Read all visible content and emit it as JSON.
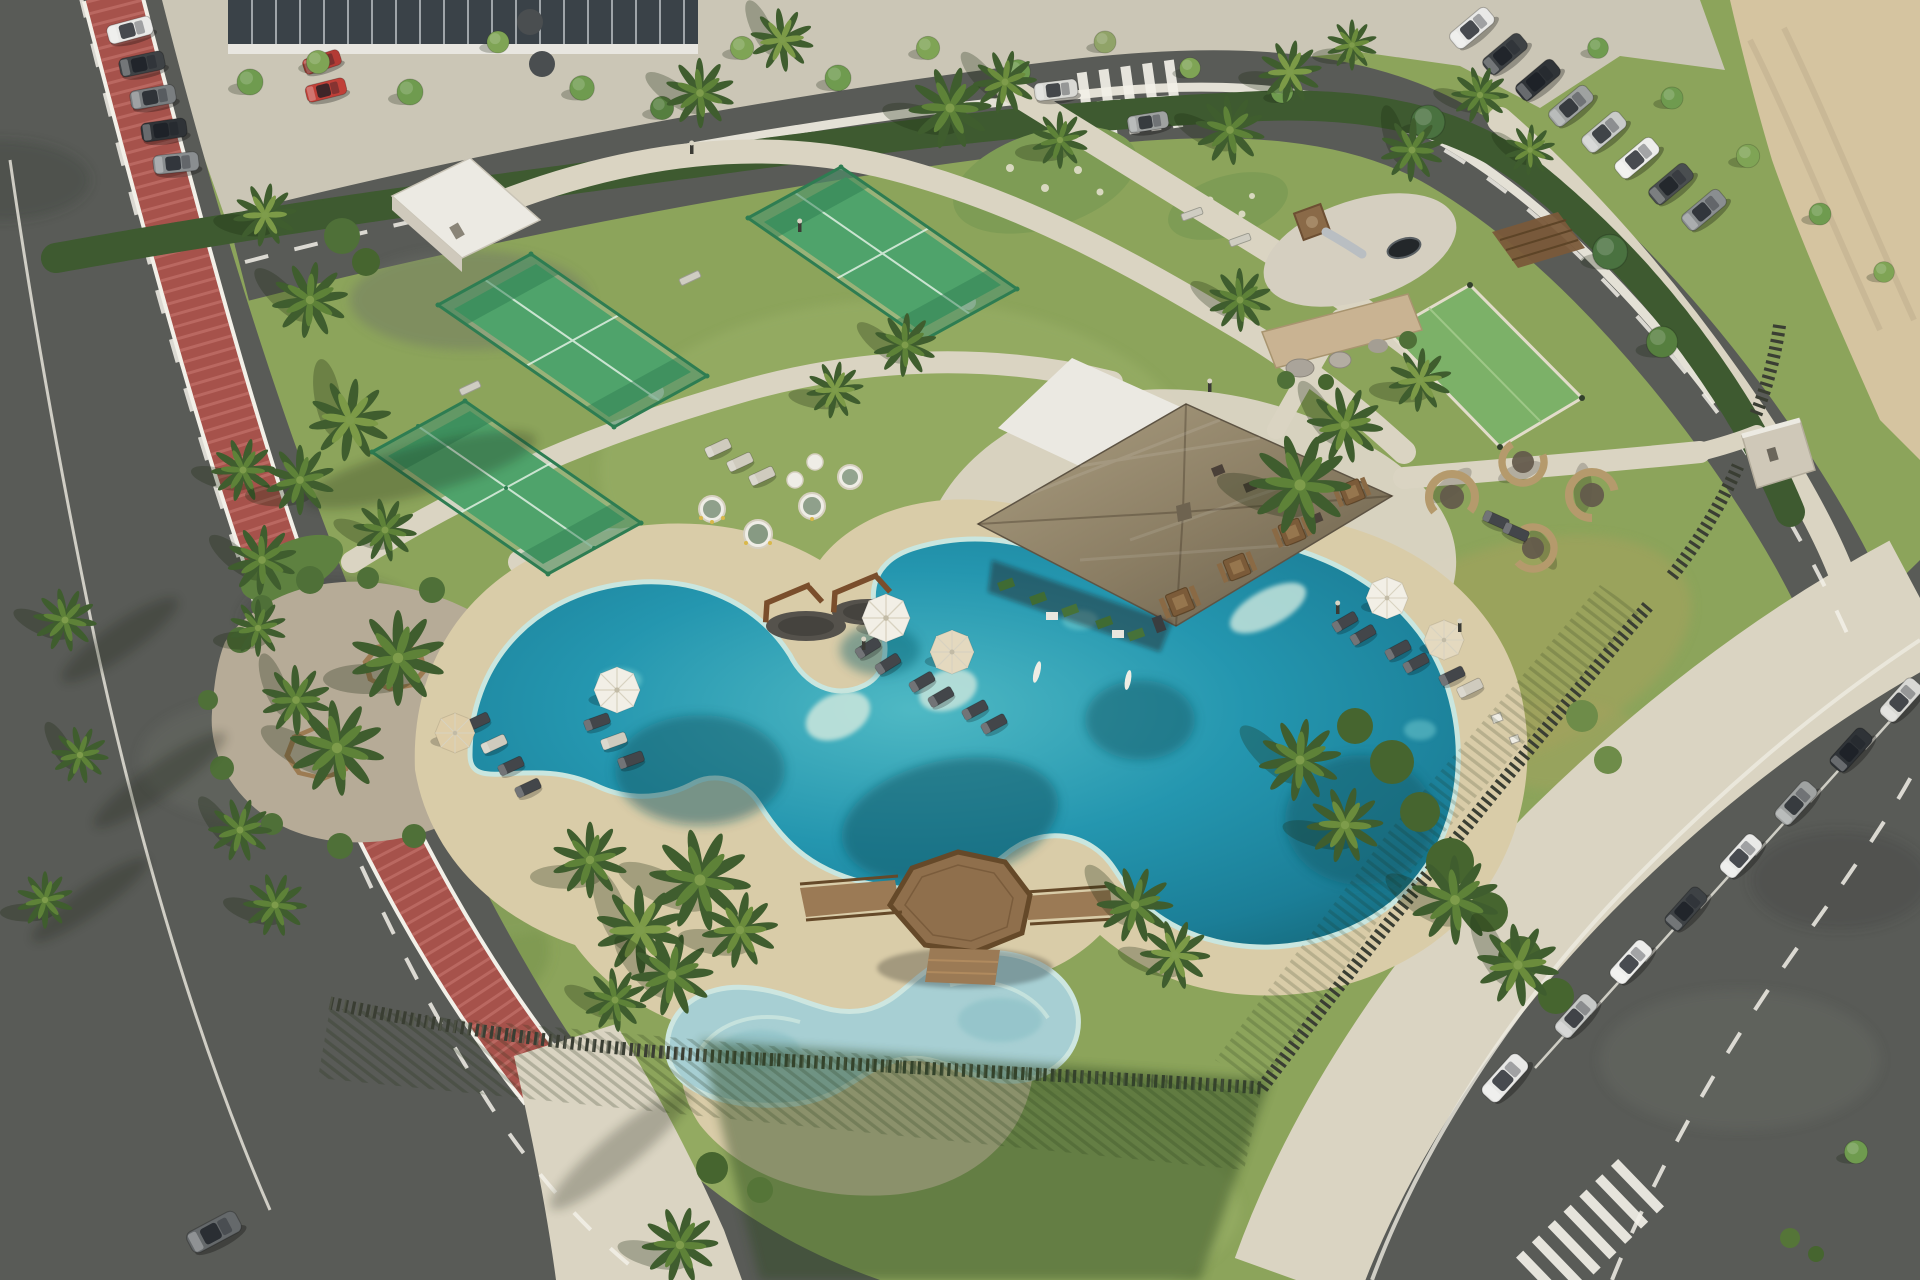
{
  "scene": {
    "title": "Resort amenity park, aerial view",
    "description": "Aerial 3D rendering of a coastal residential amenity park: three glass-walled padel courts, a thatched-roof pool pavilion, a free-form turquoise lagoon pool with sandy deck, a children's splash pool joined by an octagonal timber deck, playground, picnic grove with circular tree benches, lounge pods, lawns and palm trees, ringed by a road with a red bike lane on the west, a curved access road on the north, angled parking rows full of cars on the east, and a bare sand lot in the north-east corner."
  },
  "palette": {
    "grass": "#8CA45B",
    "grassLight": "#A7B874",
    "grassDark": "#6A8A44",
    "hedge": "#3E5A30",
    "sandLot": "#D5C4A0",
    "plaza": "#CBC6B6",
    "path": "#DAD4C2",
    "poolDeck": "#D9CCA8",
    "road": "#595B57",
    "bike": "#A6524B",
    "bikeLight": "#BF6E66",
    "fence": "#3A3E33",
    "wood": "#8F6F4C",
    "woodDark": "#654929",
    "thatchLight": "#AC9F82",
    "thatchDark": "#6B604C",
    "white": "#EBE9E2",
    "water": "#2496AF",
    "waterDeep": "#0F5A66",
    "waterShallow": "#C3E3DA",
    "kidsWater": "#A7CFD3",
    "gravel": "#B6AB97",
    "court": "#4FA36B",
    "courtFrame": "#2E7D52",
    "courtLine": "#DFF0E2",
    "carWhite": "#E9E9E7",
    "carGray": "#9FA2A1",
    "carDark": "#3E4245",
    "carRed": "#B33B35",
    "canopyTree": "#6F9B4F",
    "palmDark": "#3F5D2E",
    "palmMid": "#5E8238"
  },
  "inventory": {
    "amenities": [
      "padel court with glass walls (x3)",
      "mini multi-sport turf court",
      "children playground with timber tower, slide and trampoline",
      "picnic grove with octagonal timber tree benches (x2)",
      "timber swing frames (x2)",
      "thatched-roof pool bar pavilion with white service building",
      "outdoor grill dining tables (x4)",
      "round wicker lounge pods (x4)",
      "free-form lagoon swimming pool",
      "children splash pool",
      "octagonal timber pool deck with bridge walkways",
      "sun loungers with white parasols",
      "white storage kiosk",
      "stone feature wall with boulders"
    ],
    "vehicles": {
      "street_parking_northwest": 5,
      "red_vehicles_at_building": 2,
      "parked_row_northeast": 8,
      "parked_row_southeast": 8,
      "moving_cars": 3
    },
    "circulation": [
      "west road with red bike lane",
      "north curved access road with zebra crossing",
      "southeast parking road with zebra crossing",
      "beige pedestrian paths",
      "timber slat boundary fence",
      "clipped hedge boundary"
    ]
  }
}
